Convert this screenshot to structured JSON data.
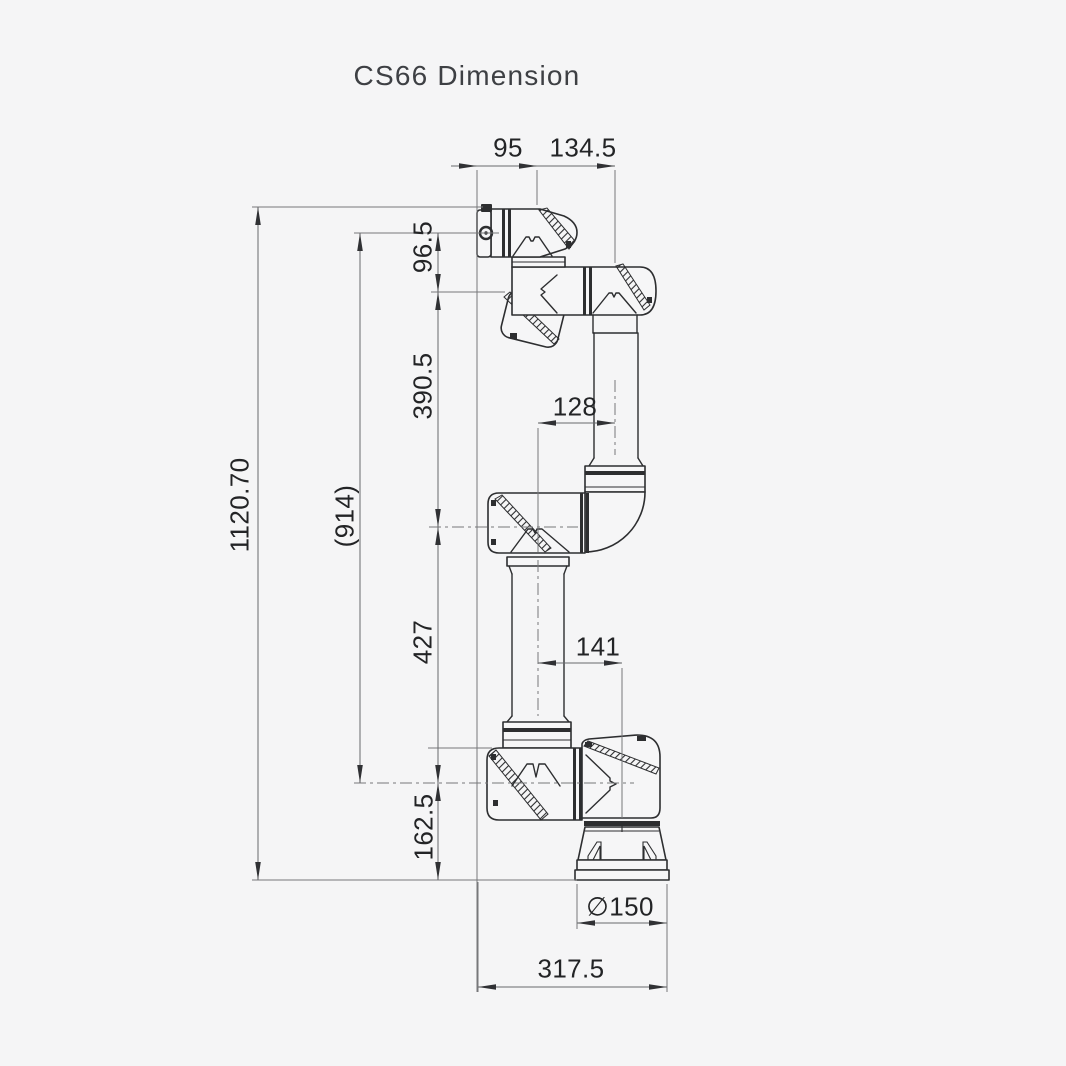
{
  "title": "CS66 Dimension",
  "dims": {
    "flange_offset": "95",
    "wrist_offset": "134.5",
    "wrist_height": "96.5",
    "forearm_length": "390.5",
    "total_height": "1120.70",
    "reach": "(914)",
    "elbow_offset": "128",
    "upper_arm_length": "427",
    "base_offset": "141",
    "base_height": "162.5",
    "base_diameter": "∅150",
    "footprint_width": "317.5"
  },
  "colors": {
    "background": "#f5f5f6",
    "line": "#2d2e30",
    "dim_line": "#77787a",
    "text": "#232426"
  }
}
